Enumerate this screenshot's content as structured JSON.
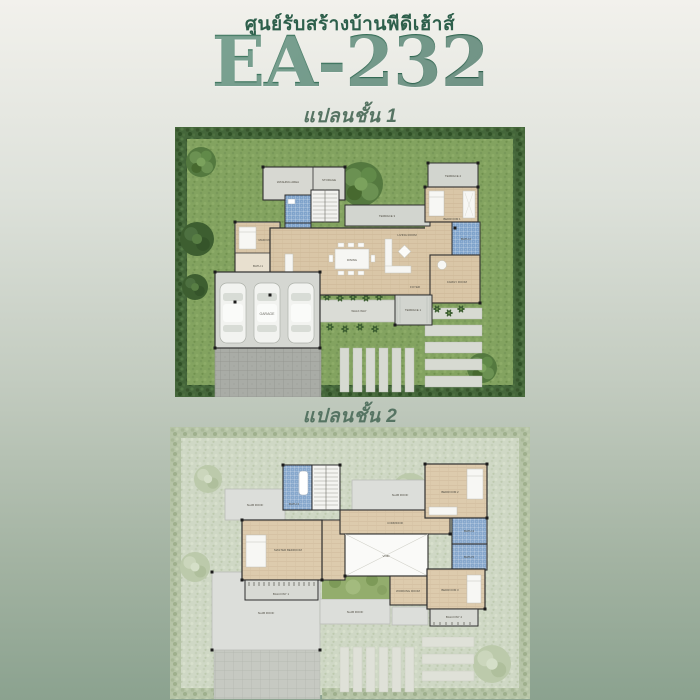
{
  "header": {
    "company": "ศูนย์รับสร้างบ้านพีดีเฮ้าส์",
    "model": "EA-232"
  },
  "colors": {
    "accent_green": "#2d5f4b",
    "title_gradient_top": "#478166",
    "title_gradient_bottom": "#1d4737",
    "subtitle_green": "#567463",
    "lawn": "#83a360",
    "hedge": "#44663a",
    "wood_floor": "#d9c6a7",
    "bath_tile": "#7fa3cb",
    "concrete_terrace": "#d2d5cf",
    "paver_gray": "#a9aca6"
  },
  "plan1": {
    "label": "แปลนชั้น 1",
    "rooms": {
      "washing": "WASHING AREA",
      "storage": "STORAGE",
      "maid": "MAID ROOM",
      "bath1": "BATH 1",
      "storage2": "STORAGE 2",
      "kitchen": "THAI KITCHEN",
      "dining": "DINING",
      "living": "LIVING ROOM",
      "foyer": "FOYER",
      "terrace1": "TERRACE 1",
      "terrace2": "TERRACE 2",
      "terrace3": "TERRACE 3",
      "bedroom1": "BEDROOM 1",
      "bath2": "BATH 2",
      "family": "FAMILY ROOM",
      "garage": "GARAGE",
      "walkway": "WALK WAY"
    }
  },
  "plan2": {
    "label": "แปลนชั้น 2",
    "rooms": {
      "bath3": "BATH 3",
      "master": "MASTER BEDROOM",
      "corridor": "CORRIDOR",
      "void": "VOID",
      "bedroom2": "BEDROOM 2",
      "bath4": "BATH 4",
      "bath5": "BATH 5",
      "working": "WORKING ROOM",
      "bedroom3": "BEDROOM 3",
      "balcony1": "BALCONY 1",
      "balcony2": "BALCONY 2",
      "slabroof": "SLAB ROOF"
    }
  }
}
